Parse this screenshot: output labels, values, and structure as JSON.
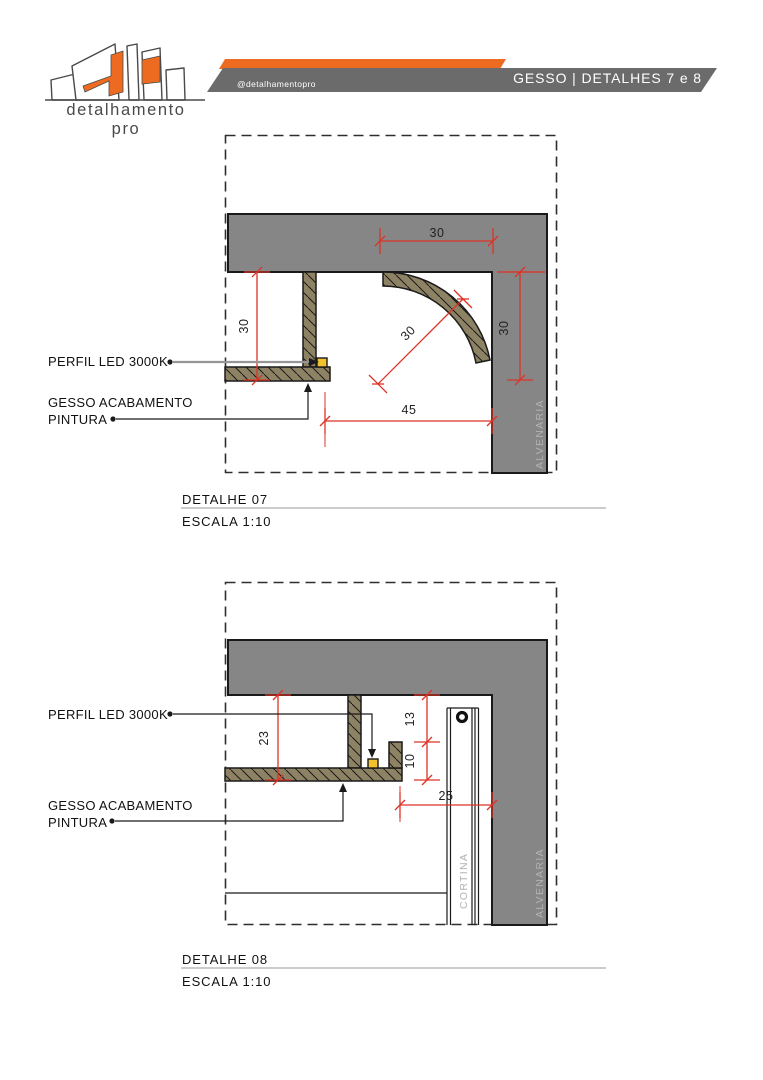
{
  "brand": {
    "logo_text": "detalhamento pro",
    "instagram_handle": "@detalhamentopro",
    "header_title": "GESSO | DETALHES 7 e 8"
  },
  "colors": {
    "accent_orange": "#ED6B21",
    "bar_gray": "#6B6B6B",
    "slab_gray": "#868686",
    "gypsum_tan": "#8D8264",
    "dim_red": "#DD3327",
    "led_yellow": "#F2C12E",
    "muted_label_gray": "#B2B2B2"
  },
  "detail07": {
    "title": "DETALHE 07",
    "scale": "ESCALA 1:10",
    "labels": {
      "led": "PERFIL LED 3000K",
      "gesso_line1": "GESSO ACABAMENTO",
      "gesso_line2": "PINTURA",
      "wall": "ALVENARIA"
    },
    "dims": {
      "top_width": "30",
      "right_drop": "30",
      "left_drop": "30",
      "cove_radius": "30",
      "bottom_offset": "45"
    }
  },
  "detail08": {
    "title": "DETALHE 08",
    "scale": "ESCALA 1:10",
    "labels": {
      "led": "PERFIL LED 3000K",
      "gesso_line1": "GESSO ACABAMENTO",
      "gesso_line2": "PINTURA",
      "wall": "ALVENARIA",
      "curtain": "CORTINA"
    },
    "dims": {
      "drop": "23",
      "upper_gap": "13",
      "lower_gap": "10",
      "curtain_offset": "25"
    }
  }
}
